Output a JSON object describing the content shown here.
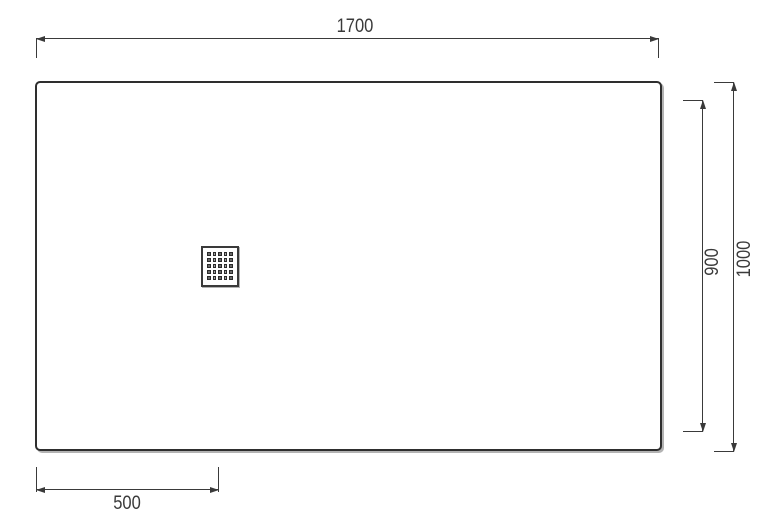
{
  "drawing": {
    "labels": {
      "top_width": "1700",
      "inner_height": "900",
      "overall_height": "1000",
      "drain_offset": "500"
    },
    "drain": {
      "rows": 5,
      "cols": 5
    },
    "colors": {
      "outline": "#2e2e2e",
      "dimension_line": "#3a3a3a",
      "text": "#3a3a3a",
      "shadow": "#b3b3b3",
      "drain_hole": "#2b2b2b",
      "background": "#ffffff"
    }
  }
}
